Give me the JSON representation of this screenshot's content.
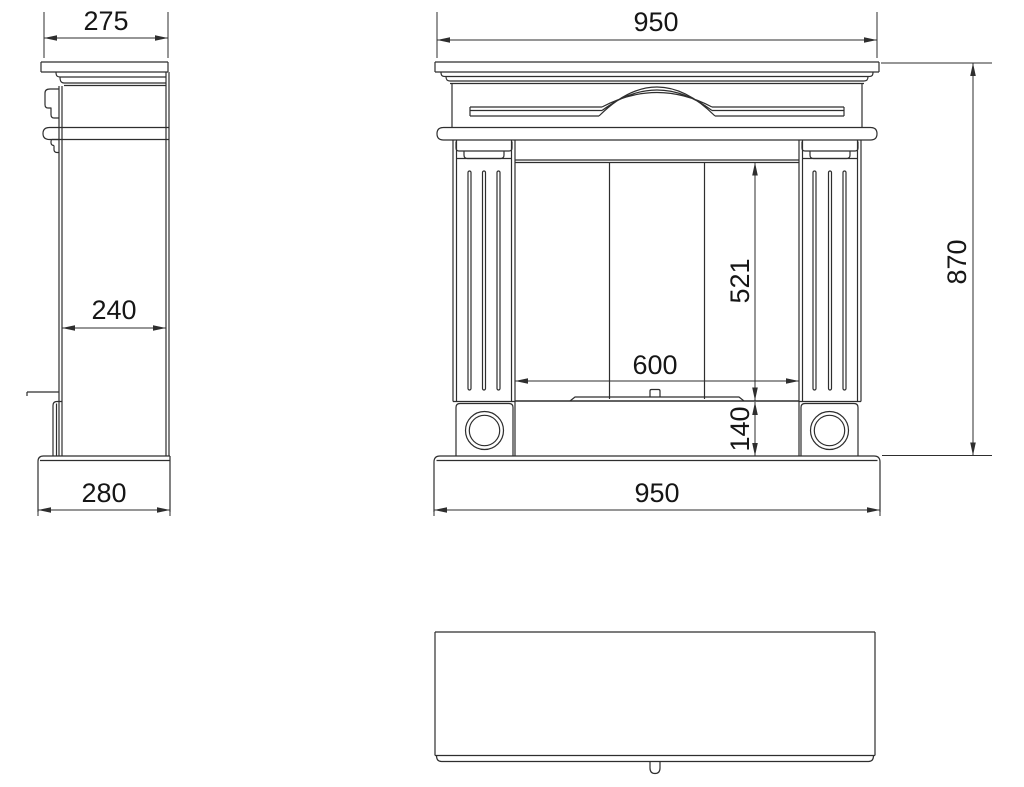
{
  "drawing": {
    "subject": "fireplace-mantel-three-view",
    "colors": {
      "line": "#2e2e2e",
      "background": "#ffffff",
      "text": "#161616"
    },
    "dimensions": {
      "side_top_depth": "275",
      "side_body_depth": "240",
      "side_base_depth": "280",
      "front_top_width": "950",
      "opening_height": "521",
      "opening_width": "600",
      "plinth_height": "140",
      "front_base_width": "950",
      "total_height": "870"
    }
  }
}
